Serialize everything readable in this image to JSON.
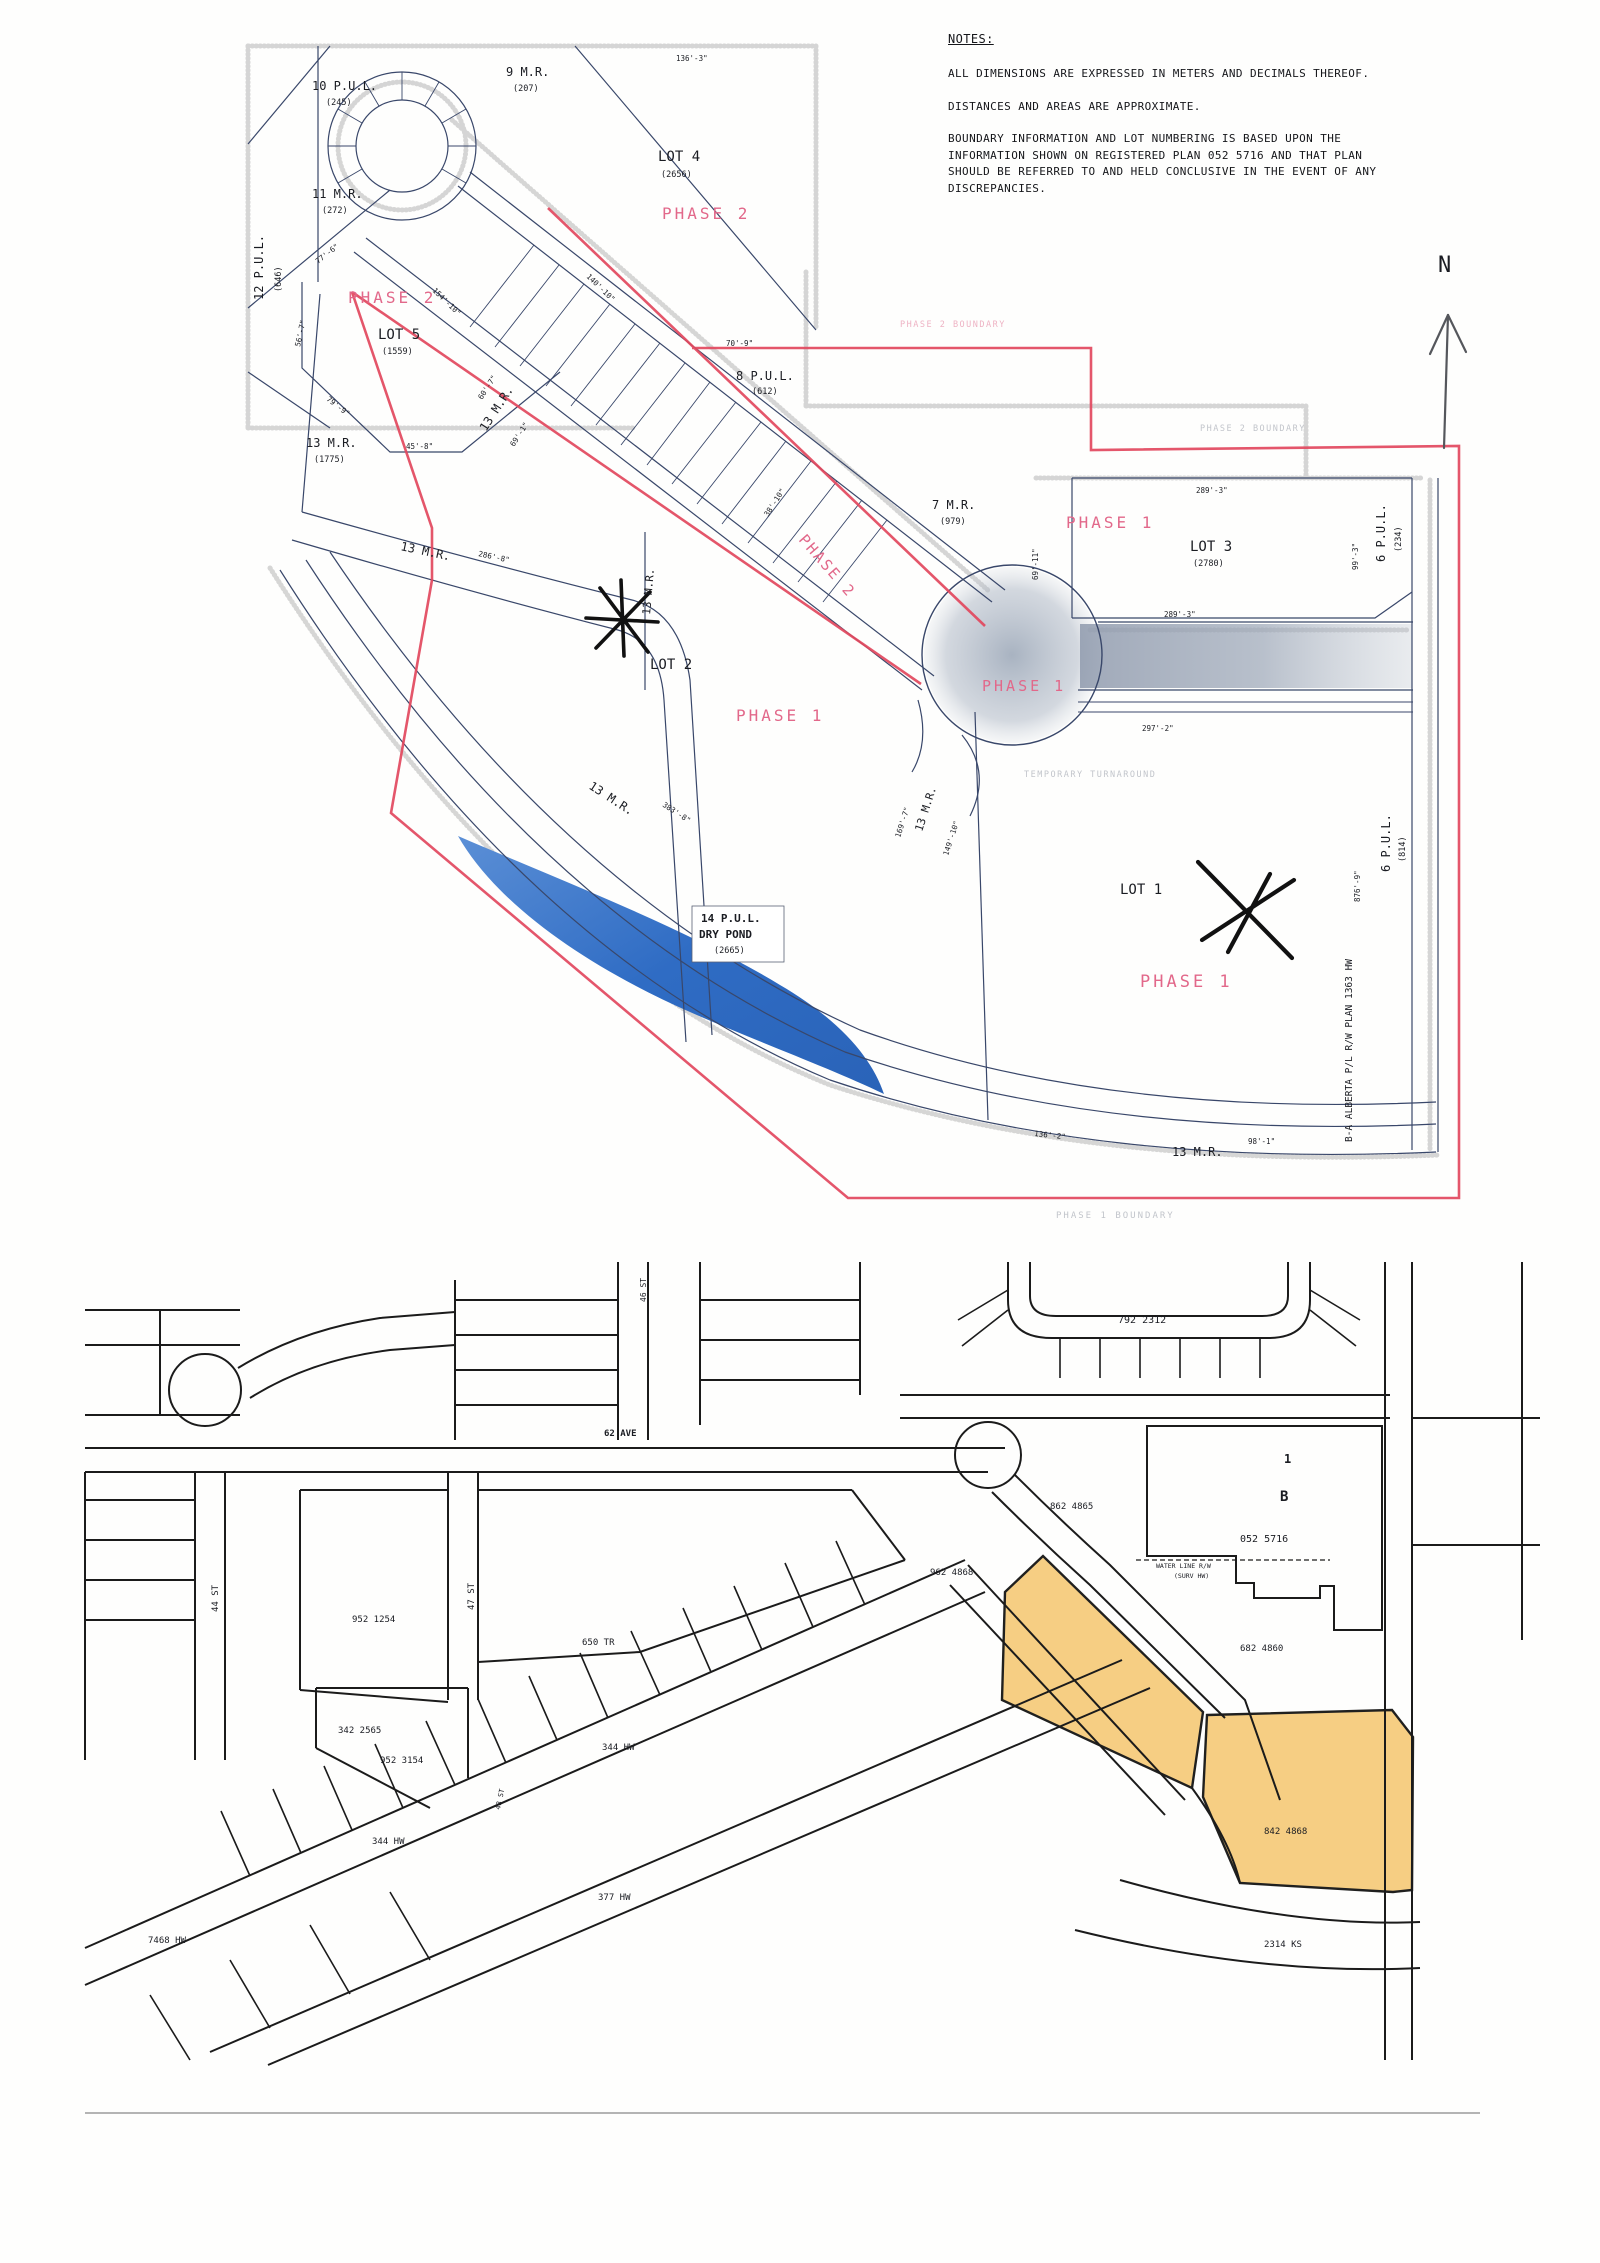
{
  "notes": {
    "title": "NOTES:",
    "lines": [
      "ALL DIMENSIONS ARE EXPRESSED IN METERS AND DECIMALS THEREOF.",
      "DISTANCES AND AREAS ARE APPROXIMATE.",
      "BOUNDARY INFORMATION AND LOT NUMBERING IS BASED UPON THE",
      "INFORMATION SHOWN ON REGISTERED PLAN 052 5716 AND THAT PLAN",
      "SHOULD BE REFERRED TO AND HELD CONCLUSIVE IN THE EVENT OF ANY",
      "DISCREPANCIES."
    ]
  },
  "compass": {
    "label": "N"
  },
  "colors": {
    "phase_boundary_red": "#e2485e",
    "phase_text_pink": "#e2688a",
    "plat_line_navy": "#39476a",
    "pond_blue": "#3c7bd0",
    "highlight_orange": "#f5c66d",
    "map_ink_black": "#191919"
  },
  "top_map": {
    "labels": [
      {
        "n": "pul-10-label",
        "t": "10 P.U.L.",
        "x": 312,
        "y": 90,
        "s": 12
      },
      {
        "n": "pul-10-area",
        "t": "(245)",
        "x": 326,
        "y": 105,
        "s": 8.5
      },
      {
        "n": "mr-9-label",
        "t": "9 M.R.",
        "x": 506,
        "y": 76,
        "s": 12
      },
      {
        "n": "mr-9-area",
        "t": "(207)",
        "x": 513,
        "y": 91,
        "s": 8.5
      },
      {
        "n": "lot-4-label",
        "t": "LOT 4",
        "x": 658,
        "y": 161,
        "s": 14
      },
      {
        "n": "lot-4-area",
        "t": "(2656)",
        "x": 661,
        "y": 177,
        "s": 8.5
      },
      {
        "n": "phase-2-lot4-label",
        "t": "PHASE 2",
        "x": 662,
        "y": 219,
        "s": 16,
        "c": "pink",
        "sp": 3
      },
      {
        "n": "mr-11-label",
        "t": "11 M.R.",
        "x": 312,
        "y": 198,
        "s": 12
      },
      {
        "n": "mr-11-area",
        "t": "(272)",
        "x": 322,
        "y": 213,
        "s": 8.5
      },
      {
        "n": "pul-12-label",
        "t": "12 P.U.L.",
        "x": 263,
        "y": 300,
        "s": 12,
        "r": -90
      },
      {
        "n": "pul-12-area",
        "t": "(646)",
        "x": 281,
        "y": 292,
        "s": 8.5,
        "r": -90
      },
      {
        "n": "phase-2-lot5-label",
        "t": "PHASE 2",
        "x": 348,
        "y": 303,
        "s": 16,
        "c": "pink",
        "sp": 3
      },
      {
        "n": "lot-5-label",
        "t": "LOT 5",
        "x": 378,
        "y": 339,
        "s": 14
      },
      {
        "n": "lot-5-area",
        "t": "(1559)",
        "x": 382,
        "y": 354,
        "s": 8.5
      },
      {
        "n": "mr-13-west-label",
        "t": "13 M.R.",
        "x": 306,
        "y": 447,
        "s": 12
      },
      {
        "n": "mr-13-west-area",
        "t": "(1775)",
        "x": 314,
        "y": 462,
        "s": 8.5
      },
      {
        "n": "mr-13-roadside-label",
        "t": "13 M.R.",
        "x": 486,
        "y": 432,
        "s": 12,
        "r": -57
      },
      {
        "n": "pul-8-label",
        "t": "8 P.U.L.",
        "x": 736,
        "y": 380,
        "s": 12
      },
      {
        "n": "pul-8-area",
        "t": "(612)",
        "x": 752,
        "y": 394,
        "s": 8.5
      },
      {
        "n": "mr-7-label",
        "t": "7 M.R.",
        "x": 932,
        "y": 509,
        "s": 12
      },
      {
        "n": "mr-7-area",
        "t": "(979)",
        "x": 940,
        "y": 524,
        "s": 8.5
      },
      {
        "n": "phase-1-lot3-label",
        "t": "PHASE 1",
        "x": 1066,
        "y": 528,
        "s": 16,
        "c": "pink",
        "sp": 3
      },
      {
        "n": "lot-3-label",
        "t": "LOT 3",
        "x": 1190,
        "y": 551,
        "s": 14
      },
      {
        "n": "lot-3-area",
        "t": "(2780)",
        "x": 1193,
        "y": 566,
        "s": 8.5
      },
      {
        "n": "pul-6-ne-label",
        "t": "6 P.U.L.",
        "x": 1385,
        "y": 562,
        "s": 12,
        "r": -90
      },
      {
        "n": "pul-6-ne-area",
        "t": "(234)",
        "x": 1401,
        "y": 552,
        "s": 8.5,
        "r": -90
      },
      {
        "n": "phase-2-road-label",
        "t": "PHASE 2",
        "x": 798,
        "y": 540,
        "s": 15,
        "c": "pink",
        "sp": 2,
        "r": 49
      },
      {
        "n": "lot-2-label",
        "t": "LOT 2",
        "x": 650,
        "y": 669,
        "s": 14
      },
      {
        "n": "phase-1-lot2-label",
        "t": "PHASE 1",
        "x": 736,
        "y": 721,
        "s": 16,
        "c": "pink",
        "sp": 3
      },
      {
        "n": "phase-1-road-label",
        "t": "PHASE 1",
        "x": 982,
        "y": 691,
        "s": 15,
        "c": "pink",
        "sp": 3
      },
      {
        "n": "mr-13-mid-label",
        "t": "13 M.R.",
        "x": 400,
        "y": 550,
        "s": 12,
        "r": 12
      },
      {
        "n": "dim-286-8",
        "t": "286'-8\"",
        "x": 478,
        "y": 556,
        "s": 7.5,
        "r": 12
      },
      {
        "n": "mr-13-vert-label",
        "t": "13 M.R.",
        "x": 650,
        "y": 615,
        "s": 11,
        "r": -85
      },
      {
        "n": "mr-13-low-label",
        "t": "13 M.R.",
        "x": 588,
        "y": 788,
        "s": 12,
        "r": 33
      },
      {
        "n": "dim-383-8",
        "t": "383'-8\"",
        "x": 662,
        "y": 806,
        "s": 7.5,
        "r": 33
      },
      {
        "n": "mr-13-junction-label",
        "t": "13 M.R.",
        "x": 922,
        "y": 832,
        "s": 11,
        "r": -72
      },
      {
        "n": "dim-169-7",
        "t": "169'-7\"",
        "x": 900,
        "y": 838,
        "s": 7.5,
        "r": -72
      },
      {
        "n": "dim-149-10",
        "t": "149'-10\"",
        "x": 948,
        "y": 856,
        "s": 7.5,
        "r": -72
      },
      {
        "n": "lot-1-label",
        "t": "LOT 1",
        "x": 1120,
        "y": 894,
        "s": 14
      },
      {
        "n": "phase-1-lot1-label",
        "t": "PHASE 1",
        "x": 1140,
        "y": 987,
        "s": 17,
        "c": "pink",
        "sp": 3
      },
      {
        "n": "pul-6-se-label",
        "t": "6 P.U.L.",
        "x": 1390,
        "y": 872,
        "s": 12,
        "r": -90
      },
      {
        "n": "pul-6-se-area",
        "t": "(814)",
        "x": 1405,
        "y": 862,
        "s": 8.5,
        "r": -90
      },
      {
        "n": "dim-876-9",
        "t": "876'-9\"",
        "x": 1360,
        "y": 902,
        "s": 7.5,
        "r": -90
      },
      {
        "n": "pipeline-row-label",
        "t": "B-A ALBERTA P/L R/W PLAN 1363 HW",
        "x": 1352,
        "y": 1142,
        "s": 9.5,
        "r": -90
      },
      {
        "n": "mr-13-south-label",
        "t": "13 M.R.",
        "x": 1172,
        "y": 1156,
        "s": 12
      },
      {
        "n": "dim-136-2",
        "t": "136'-2\"",
        "x": 1034,
        "y": 1136,
        "s": 7.5,
        "r": 6
      },
      {
        "n": "dim-98-1",
        "t": "98'-1\"",
        "x": 1248,
        "y": 1144,
        "s": 7.5
      },
      {
        "n": "phase-1-boundary-label",
        "t": "PHASE 1 BOUNDARY",
        "x": 1056,
        "y": 1218,
        "s": 9,
        "c": "faint",
        "sp": 2
      },
      {
        "n": "phase-2-boundary-east-label",
        "t": "PHASE 2 BOUNDARY",
        "x": 1200,
        "y": 431,
        "s": 8.5,
        "c": "faint",
        "sp": 1.5
      },
      {
        "n": "phase-2-boundary-north-label",
        "t": "PHASE 2 BOUNDARY",
        "x": 900,
        "y": 327,
        "s": 8.5,
        "c": "faintpink",
        "sp": 1.5
      },
      {
        "n": "turnaround-label",
        "t": "TEMPORARY TURNAROUND",
        "x": 1024,
        "y": 777,
        "s": 8.5,
        "c": "faint",
        "sp": 1.5
      },
      {
        "n": "pul-14-label",
        "t": "14 P.U.L.",
        "x": 701,
        "y": 922,
        "s": 11,
        "c": "b"
      },
      {
        "n": "dry-pond-label",
        "t": "DRY POND",
        "x": 699,
        "y": 938,
        "s": 11,
        "c": "b"
      },
      {
        "n": "pul-14-area",
        "t": "(2665)",
        "x": 714,
        "y": 953,
        "s": 8.5
      },
      {
        "n": "dim-136-3",
        "t": "136'-3\"",
        "x": 676,
        "y": 61,
        "s": 7.5
      },
      {
        "n": "dim-70-9",
        "t": "70'-9\"",
        "x": 726,
        "y": 346,
        "s": 7.5
      },
      {
        "n": "dim-289-3-lot3",
        "t": "289'-3\"",
        "x": 1196,
        "y": 493,
        "s": 7.5
      },
      {
        "n": "dim-289-3-road",
        "t": "289'-3\"",
        "x": 1164,
        "y": 617,
        "s": 7.5
      },
      {
        "n": "dim-297-2",
        "t": "297'-2\"",
        "x": 1142,
        "y": 731,
        "s": 7.5
      },
      {
        "n": "dim-99-3",
        "t": "99'-3\"",
        "x": 1358,
        "y": 570,
        "s": 7.5,
        "r": -90
      },
      {
        "n": "dim-69-11",
        "t": "69'-11\"",
        "x": 1038,
        "y": 580,
        "s": 7.5,
        "r": -90
      },
      {
        "n": "dim-79-9",
        "t": "79'-9\"",
        "x": 326,
        "y": 400,
        "s": 7.5,
        "r": 38
      },
      {
        "n": "dim-45-8",
        "t": "45'-8\"",
        "x": 406,
        "y": 449,
        "s": 7.5
      },
      {
        "n": "dim-56-7",
        "t": "56'-7\"",
        "x": 300,
        "y": 347,
        "s": 7.5,
        "r": -78
      },
      {
        "n": "dim-77-6",
        "t": "77'-6\"",
        "x": 318,
        "y": 264,
        "s": 7.5,
        "r": -38
      },
      {
        "n": "dim-60-7",
        "t": "60'-7\"",
        "x": 482,
        "y": 400,
        "s": 7.5,
        "r": -57
      },
      {
        "n": "dim-69-1",
        "t": "69'-1\"",
        "x": 514,
        "y": 447,
        "s": 7.5,
        "r": -57
      },
      {
        "n": "dim-38-10",
        "t": "38'-10\"",
        "x": 768,
        "y": 517,
        "s": 7.5,
        "r": -57
      },
      {
        "n": "dim-154-10",
        "t": "154'-10\"",
        "x": 432,
        "y": 291,
        "s": 7.5,
        "r": 44
      },
      {
        "n": "dim-140-10",
        "t": "140'-10\"",
        "x": 586,
        "y": 277,
        "s": 7.5,
        "r": 44
      }
    ]
  },
  "bottom_map": {
    "labels": [
      {
        "n": "plan-792-2312-label",
        "t": "792 2312",
        "x": 1118,
        "y": 1323,
        "s": 10
      },
      {
        "n": "plan-862-4865-label",
        "t": "862 4865",
        "x": 1050,
        "y": 1509,
        "s": 9
      },
      {
        "n": "plan-962-4868-label",
        "t": "962 4868",
        "x": 930,
        "y": 1575,
        "s": 9
      },
      {
        "n": "block-1-label",
        "t": "1",
        "x": 1284,
        "y": 1463,
        "s": 12,
        "c": "b"
      },
      {
        "n": "block-b-label",
        "t": "B",
        "x": 1280,
        "y": 1501,
        "s": 14,
        "c": "b"
      },
      {
        "n": "plan-052-5716-label",
        "t": "052 5716",
        "x": 1240,
        "y": 1542,
        "s": 10
      },
      {
        "n": "water-line-row-label-1",
        "t": "WATER LINE R/W",
        "x": 1156,
        "y": 1568,
        "s": 6.5
      },
      {
        "n": "water-line-row-label-2",
        "t": "(SURV HW)",
        "x": 1174,
        "y": 1578,
        "s": 6.5
      },
      {
        "n": "plan-682-4860-label",
        "t": "682 4860",
        "x": 1240,
        "y": 1651,
        "s": 9
      },
      {
        "n": "plan-842-4868-label",
        "t": "842 4868",
        "x": 1264,
        "y": 1834,
        "s": 9
      },
      {
        "n": "plan-2314-ks-label",
        "t": "2314 KS",
        "x": 1264,
        "y": 1947,
        "s": 9
      },
      {
        "n": "ave-62-label",
        "t": "62 AVE",
        "x": 604,
        "y": 1436,
        "s": 9,
        "c": "b"
      },
      {
        "n": "st-44-label",
        "t": "44 ST",
        "x": 218,
        "y": 1612,
        "s": 9,
        "r": -90
      },
      {
        "n": "st-46-label",
        "t": "46 ST",
        "x": 646,
        "y": 1302,
        "s": 8,
        "r": -90
      },
      {
        "n": "st-47-label",
        "t": "47 ST",
        "x": 474,
        "y": 1610,
        "s": 9,
        "r": -90
      },
      {
        "n": "plan-952-1254-label",
        "t": "952 1254",
        "x": 352,
        "y": 1622,
        "s": 9
      },
      {
        "n": "plan-650-tr-label",
        "t": "650 TR",
        "x": 582,
        "y": 1645,
        "s": 9
      },
      {
        "n": "plan-342-2565-label",
        "t": "342 2565",
        "x": 338,
        "y": 1733,
        "s": 9
      },
      {
        "n": "plan-952-3154-label",
        "t": "952 3154",
        "x": 380,
        "y": 1763,
        "s": 9
      },
      {
        "n": "plan-344-hw-east-label",
        "t": "344 HW",
        "x": 602,
        "y": 1750,
        "s": 9
      },
      {
        "n": "plan-344-hw-west-label",
        "t": "344 HW",
        "x": 372,
        "y": 1844,
        "s": 9
      },
      {
        "n": "plan-377-hw-label",
        "t": "377 HW",
        "x": 598,
        "y": 1900,
        "s": 9
      },
      {
        "n": "plan-7468-hw-label",
        "t": "7468 HW",
        "x": 148,
        "y": 1943,
        "s": 9
      },
      {
        "n": "st-48-label",
        "t": "48 ST",
        "x": 500,
        "y": 1810,
        "s": 7,
        "r": -78
      }
    ]
  }
}
